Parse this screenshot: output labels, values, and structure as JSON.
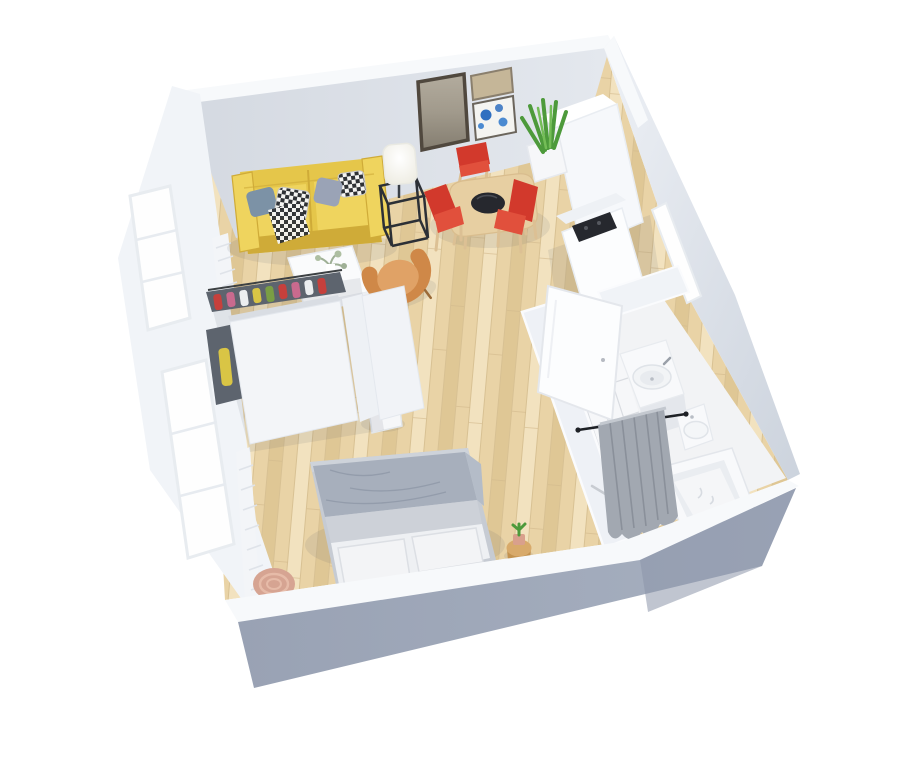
{
  "scene": {
    "title": "3D isometric floor-plan rendering of a studio apartment on a white background",
    "view": "top-down isometric 3D render",
    "rooms": [
      {
        "name": "living-room",
        "items": [
          "yellow two-seat sofa with patterned cushions",
          "white coffee table with small plant",
          "floor lamp with white shade",
          "black metal frame side table",
          "orange tub armchair",
          "potted peace lily",
          "window radiator"
        ]
      },
      {
        "name": "dining-area",
        "items": [
          "light wood dining table with black bowl",
          "three red chairs",
          "large framed artwork",
          "tan framed artwork",
          "blue framed artwork"
        ]
      },
      {
        "name": "kitchen",
        "items": [
          "white tall cabinet",
          "white counter with black cooktop",
          "snake plant in white planter"
        ]
      },
      {
        "name": "bedroom",
        "items": [
          "double bed with grey blanket and two white pillows",
          "open wardrobe with hanging clothes",
          "round pink pouf",
          "cactus on wooden stool",
          "window radiator"
        ]
      },
      {
        "name": "bathroom",
        "items": [
          "washbasin vanity",
          "toilet",
          "shower with grey curtain on black rod",
          "bathtub",
          "open white door",
          "entrance opening in right wall"
        ]
      }
    ]
  },
  "palette": {
    "bg": "#ffffff",
    "floor_wood": "#e9d3a6",
    "floor_wood_light": "#f2e2bf",
    "floor_wood_dark": "#dfc795",
    "plank_line": "#d2b98c",
    "wall_face": "#d4d9e1",
    "wall_face_light": "#e4e8ee",
    "wall_top": "#f7f9fb",
    "wall_left": "#f1f4f8",
    "wall_outer": "#dde2ea",
    "wall_outer_dark": "#97a1b3",
    "window_white": "#fefefe",
    "sofa": "#e5c64a",
    "sofa_light": "#efd45e",
    "sofa_dark": "#cfab38",
    "pillow_blue": "#7c92a6",
    "pillow_lav": "#9aa3b6",
    "checker_dark": "#2e3135",
    "table_white": "#fafbfc",
    "lamp": "#fffef4",
    "metal": "#2c3036",
    "armchair": "#cf8848",
    "armchair_light": "#e0a266",
    "wood_furn": "#e7cfa2",
    "tray": "#26282e",
    "chair_red": "#d2392c",
    "chair_red_light": "#e1503c",
    "leg_wood": "#dcc094",
    "green": "#4d9a3b",
    "green_dark": "#39762c",
    "green_light": "#74bd57",
    "pot": "#f6f7f9",
    "art_frame": "#50483e",
    "art_taupe": "#a19a8c",
    "art_tan": "#c5b698",
    "art_blue": "#2f6fc0",
    "closet_dark": "#5d646e",
    "closet_frame": "#8d949e",
    "cloth_yellow": "#d9c545",
    "cloth_red": "#c6403c",
    "cloth_pink": "#c96a8e",
    "cloth_green": "#7a9e44",
    "bed_frame": "#c6cbd3",
    "blanket": "#a7afbc",
    "blanket_dark": "#939cab",
    "sheet": "#cdd1d8",
    "bpillow": "#f3f4f6",
    "pouf": "#d6a492",
    "pouf_light": "#e6bba8",
    "stool_wood": "#d8aa6b",
    "bath_floor": "#f2f3f5",
    "tile_line": "#d9dce1",
    "curtain": "#a2a8b1",
    "curtain_dark": "#8a909a",
    "rod": "#1e2126",
    "fixture": "#f8f9fb",
    "fixture_shadow": "#e4e7ec",
    "door": "#fcfdfe"
  }
}
